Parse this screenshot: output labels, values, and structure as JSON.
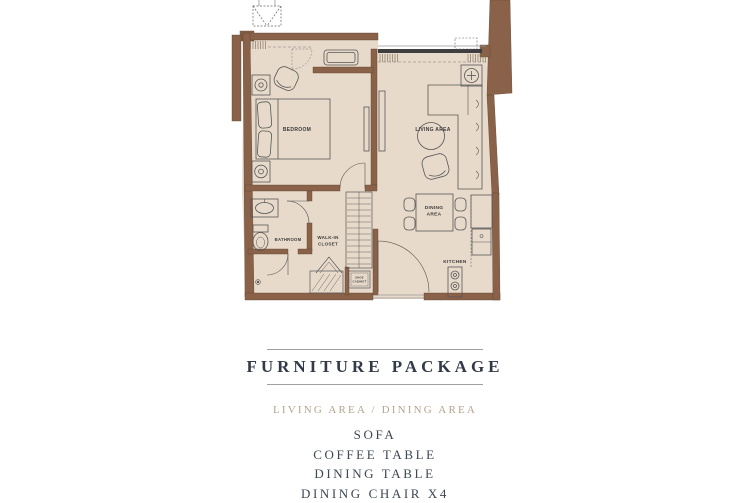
{
  "plan": {
    "rooms": {
      "bedroom": "BEDROOM",
      "living_area": "LIVING AREA",
      "dining_line1": "DINING",
      "dining_line2": "AREA",
      "kitchen": "KITCHEN",
      "bathroom": "BATHROOM",
      "walkin_line1": "WALK-IN",
      "walkin_line2": "CLOSET",
      "shoe_line1": "SHOE",
      "shoe_line2": "CABINET"
    },
    "colors": {
      "wall": "#8a6249",
      "floor": "#e8dacb",
      "line": "#555555",
      "sliding_door": "#3f3f3f"
    }
  },
  "package": {
    "title": "FURNITURE PACKAGE",
    "subtitle": "LIVING AREA / DINING AREA",
    "items": [
      "SOFA",
      "COFFEE TABLE",
      "DINING TABLE",
      "DINING CHAIR X4"
    ],
    "colors": {
      "title": "#323a48",
      "subtitle": "#b4a48e",
      "item": "#3e4753",
      "rule": "#a0a0a0"
    }
  }
}
